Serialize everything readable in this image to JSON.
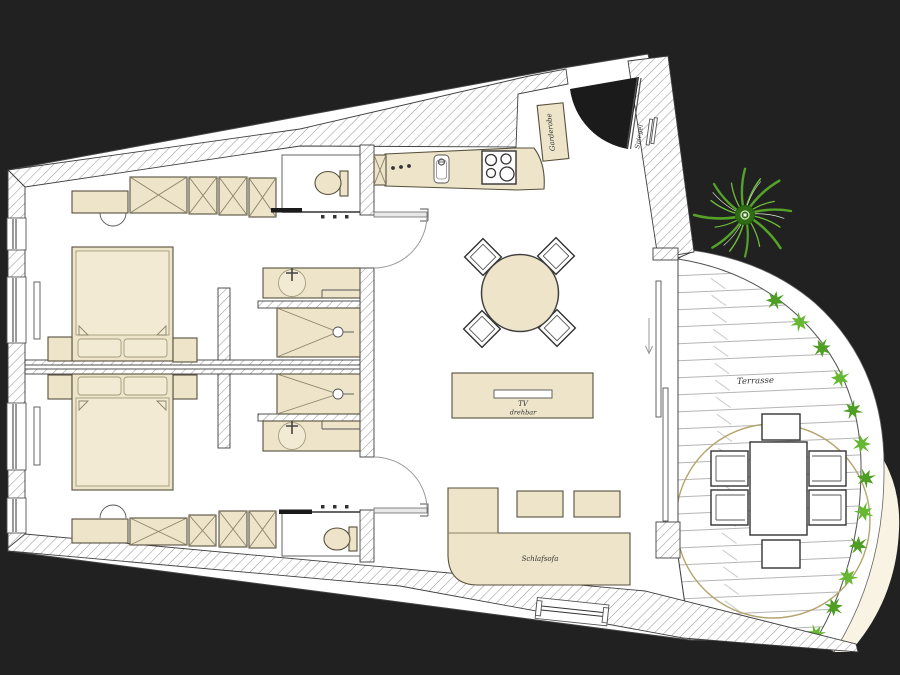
{
  "title": "apartment-floor-plan",
  "colors": {
    "background": "#212121",
    "floor": "#ffffff",
    "wall_hatch_line": "#9a9a9a",
    "wall_outline": "#3f3f3f",
    "furniture_fill": "#EDE4C9",
    "furniture_fill_light": "#F2EAD3",
    "furniture_outline": "#56503C",
    "fixture_outline": "#555555",
    "door_arc": "#999999",
    "entry_shadow": "#1B1B1B",
    "deck_line": "#B5B5B5",
    "parasol_ring": "#B3A56B",
    "garden_cream": "#F8F3E3",
    "plant_green": "#55A228",
    "plant_green_light": "#6FBE37",
    "plant_center": "#2E6D13",
    "shrub_green": "#4F9E24",
    "shrub_green_light": "#66B832"
  },
  "labels": {
    "garderobe": "Garderobe",
    "spiegel": "Spiegel",
    "tv": "TV",
    "tv_drehbar": "drehbar",
    "schlafsofa": "Schlafsofa",
    "terrasse": "Terrasse"
  }
}
